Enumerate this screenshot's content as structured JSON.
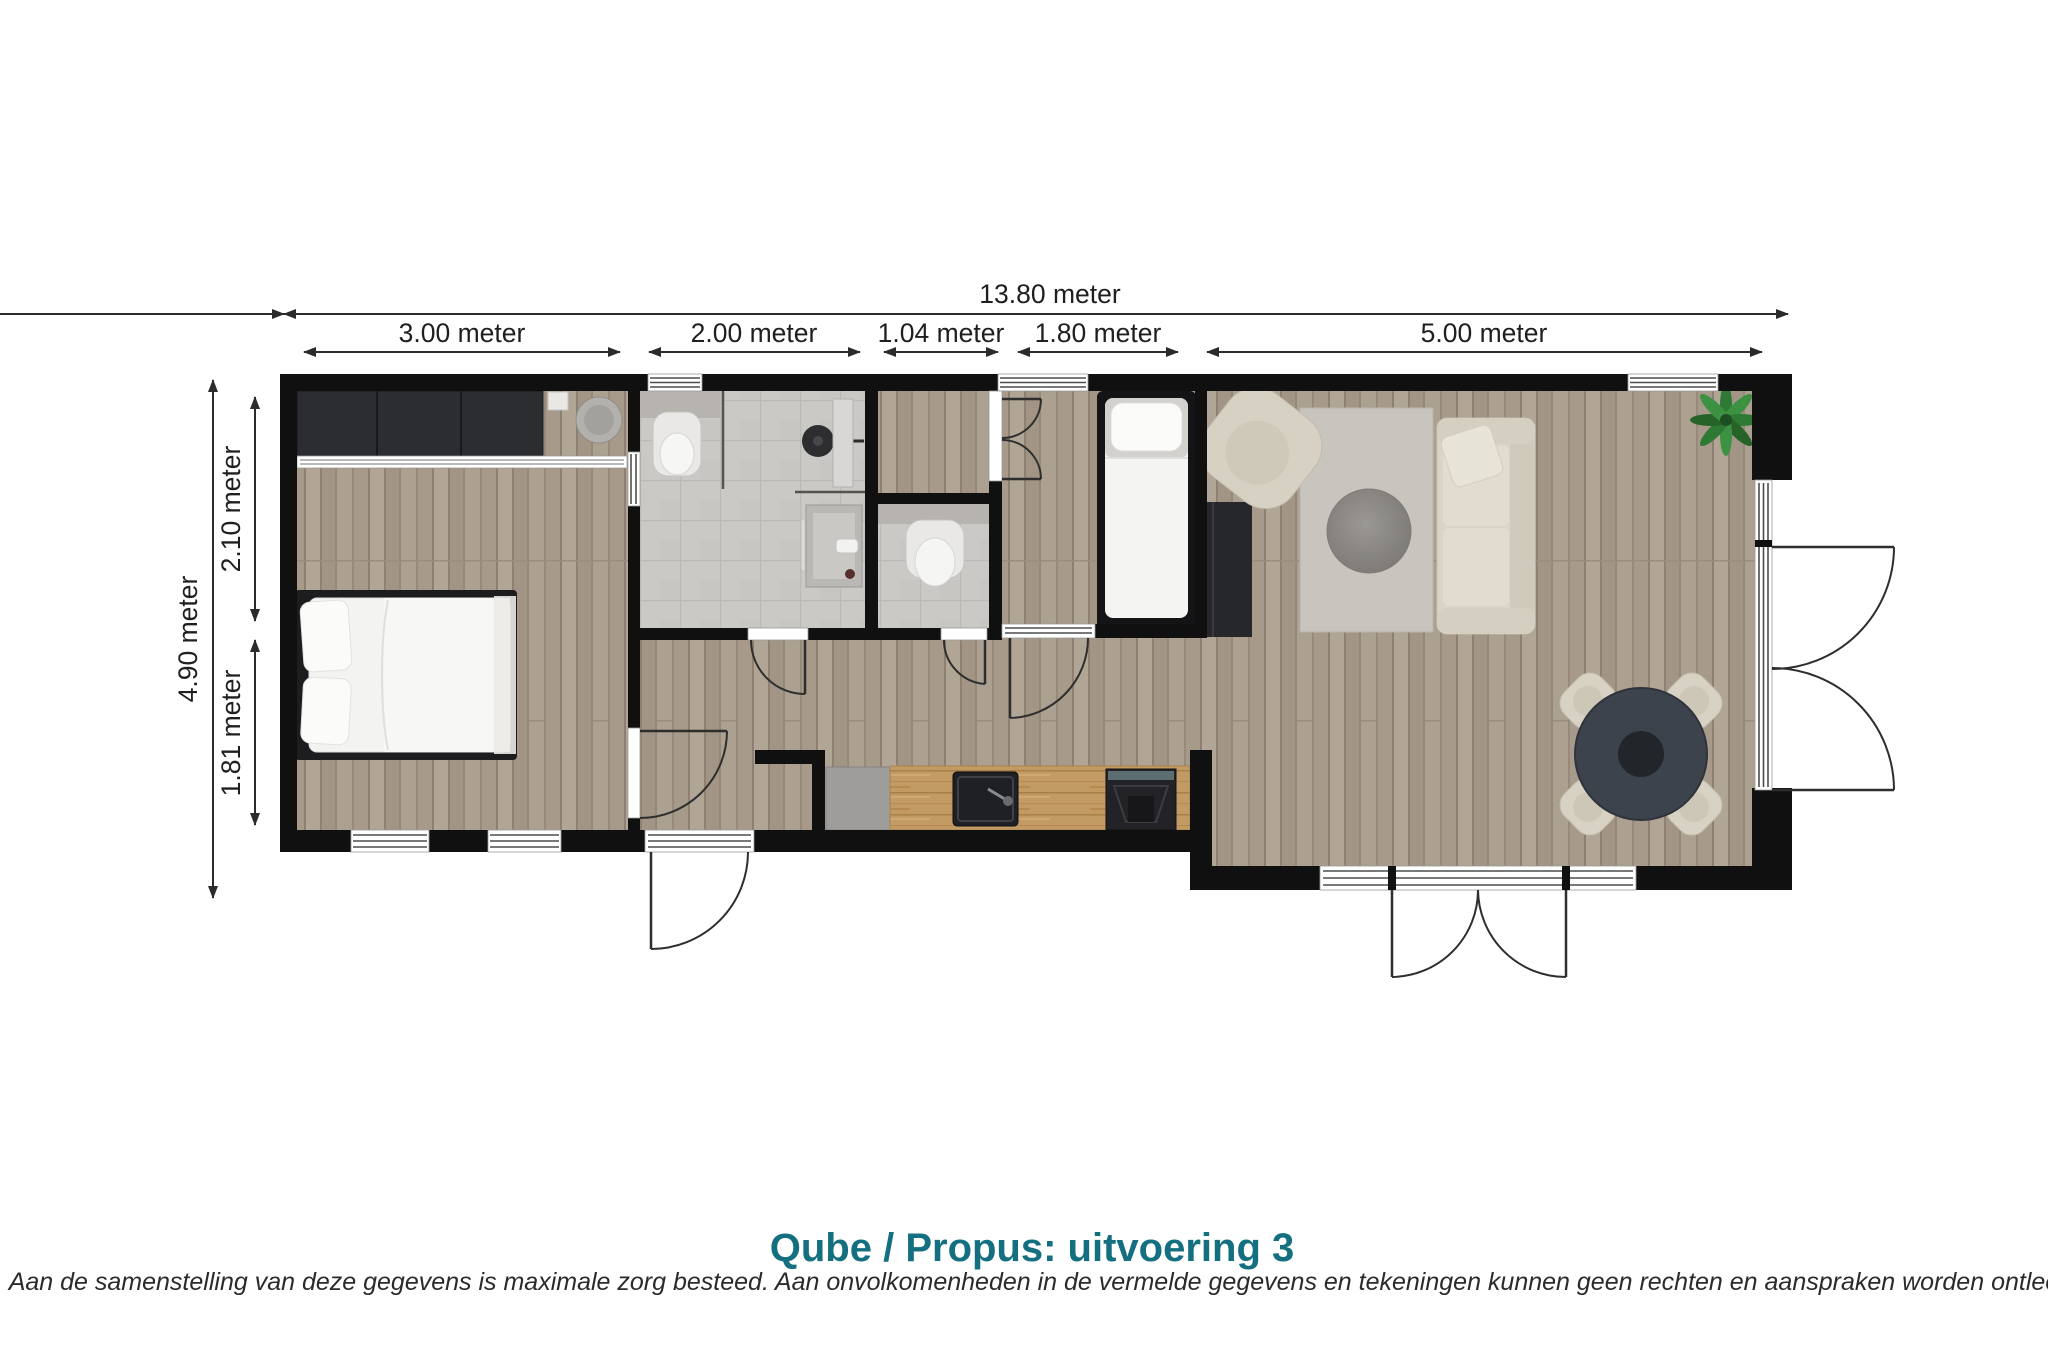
{
  "plan": {
    "title": "Qube / Propus: uitvoering 3",
    "disclaimer": "N.B. Aan de samenstelling van deze gegevens is maximale zorg besteed. Aan onvolkomenheden in de vermelde gegevens en tekeningen kunnen geen rechten en aanspraken worden ontleend.",
    "dimensions": {
      "total_width": "13.80 meter",
      "top_segments": [
        "3.00 meter",
        "2.00 meter",
        "1.04 meter",
        "1.80 meter",
        "5.00 meter"
      ],
      "total_depth": "4.90 meter",
      "left_segments": [
        "2.10 meter",
        "1.81 meter"
      ]
    },
    "colors": {
      "title_accent": "#146f80",
      "wall": "#101010",
      "wood_floor": "#a89b8c",
      "tile_floor": "#cbc9c6",
      "kitchen_counter_wood": "#c29b64",
      "dark_furniture": "#2c2d31",
      "dining_table": "#3d434d",
      "upholstery": "#d9d3c6",
      "rug": "#c8c4be",
      "dimension_text": "#1f1f1f"
    }
  }
}
